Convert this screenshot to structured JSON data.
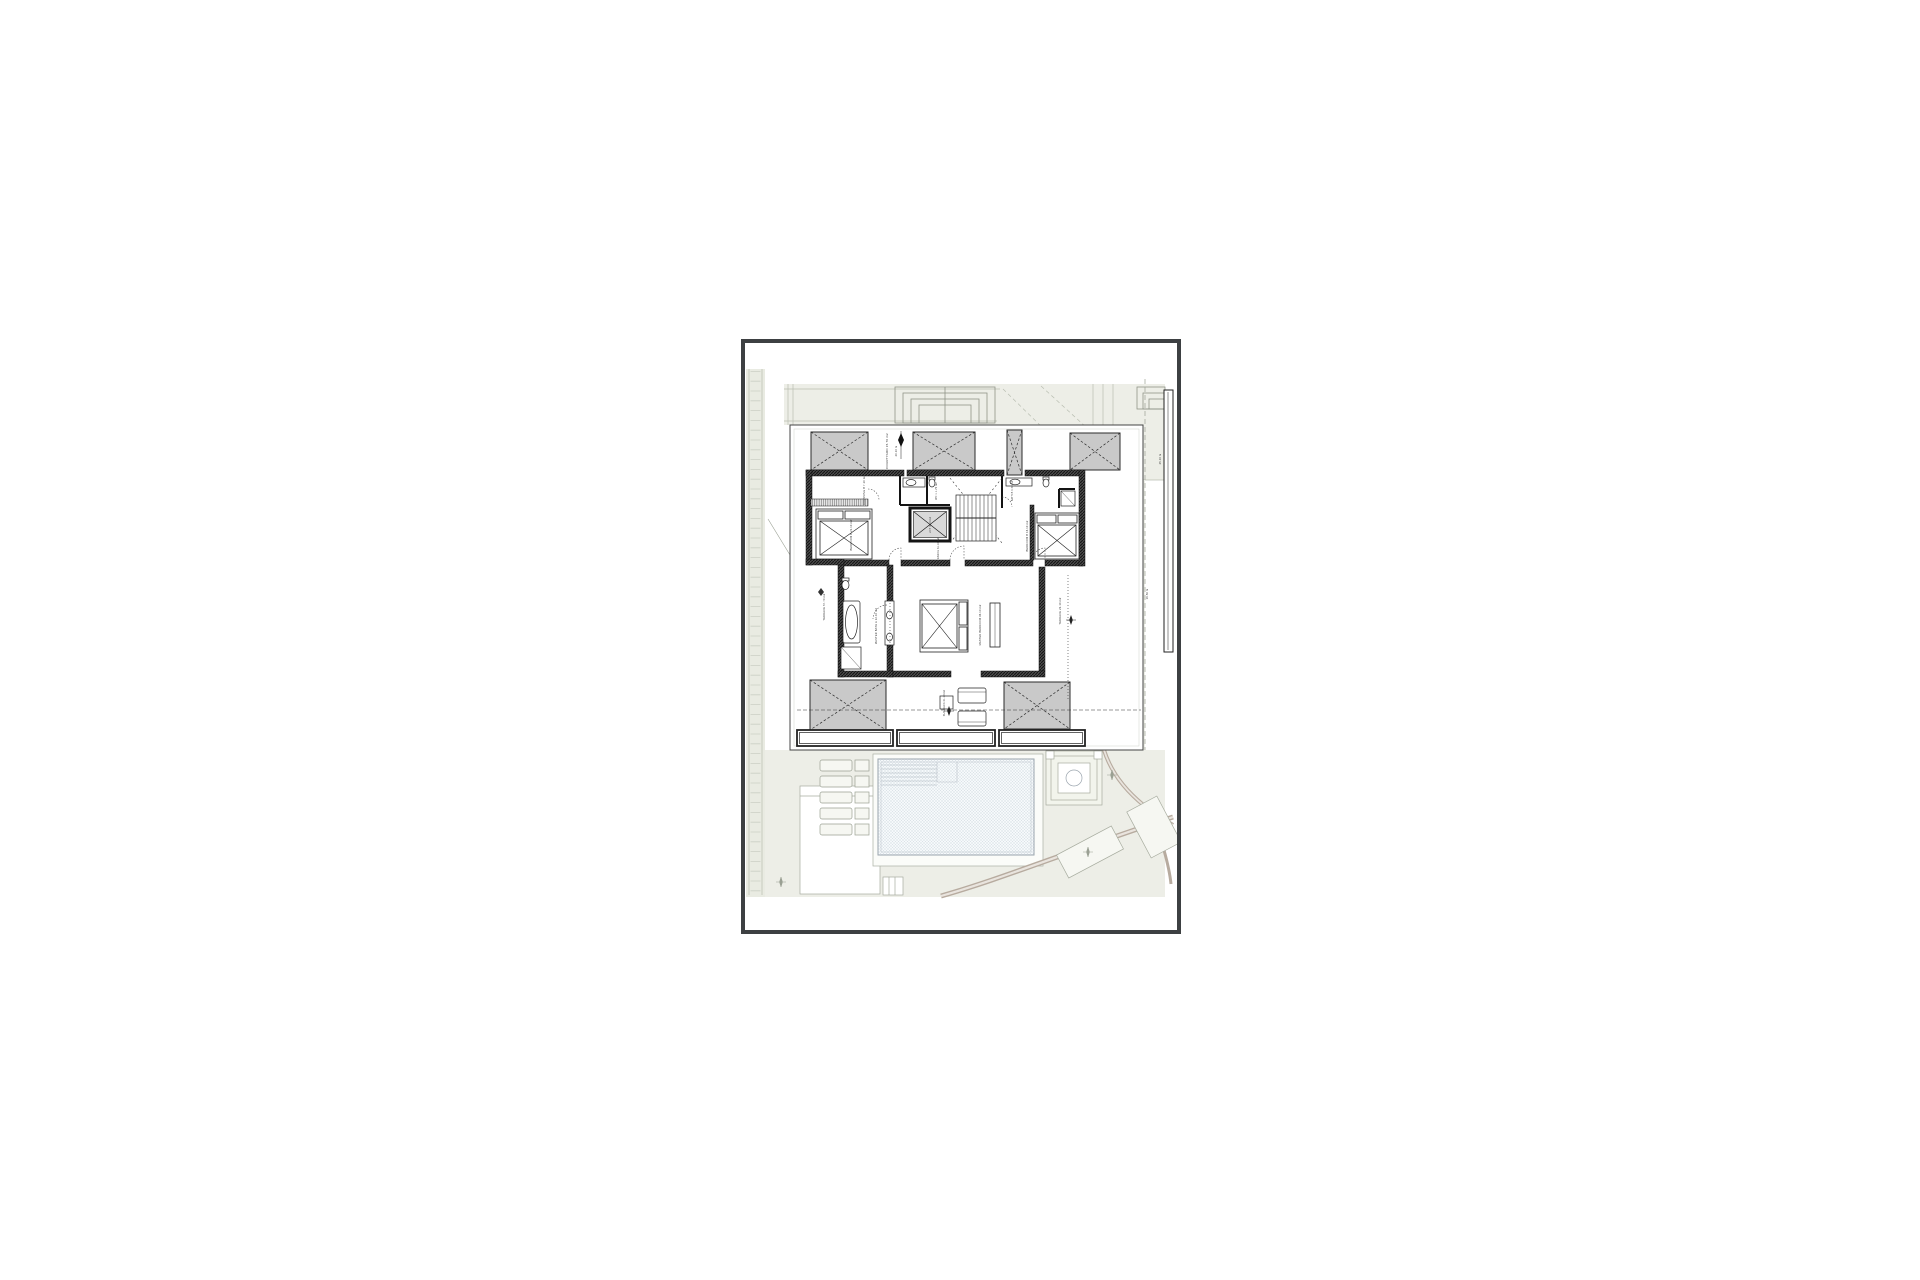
{
  "document": {
    "type": "architectural floor plan sheet",
    "background": "#ffffff",
    "sheet_border_color": "#3d4042",
    "site_tint_color": "#edeee7",
    "site_line_color": "#b9beb1",
    "road_color": "#b7ab9f",
    "wall_color": "#1a1a1a",
    "roof_hatch_fill": "#c9c9c9",
    "pool_line_color": "#9aa4ad"
  },
  "labels": [
    {
      "id": "courtyard",
      "text": "COURTYARD 15.70 m2"
    },
    {
      "id": "dim-top",
      "text": "20.10 m"
    },
    {
      "id": "dressing",
      "text": "DRESSING B 7.10 m2"
    },
    {
      "id": "bedroom-b",
      "text": "BEDROOM B 21.10 m2"
    },
    {
      "id": "wc-1",
      "text": "WC 1  1.70 m2"
    },
    {
      "id": "lift",
      "text": "LIFT 3.10 m2"
    },
    {
      "id": "bath-b",
      "text": "BATH B 4.70 m2"
    },
    {
      "id": "bedroom-c",
      "text": "BEDROOM B 16.10 m2"
    },
    {
      "id": "hall",
      "text": "ENTRANCE 31.10 m2"
    },
    {
      "id": "terrace-left",
      "text": "TERRACE 57.70 m2"
    },
    {
      "id": "master-bath",
      "text": "MASTER BATH A 12.10 m2"
    },
    {
      "id": "master-bedroom",
      "text": "MASTER BEDROOM 36.10 m2"
    },
    {
      "id": "terrace-right",
      "text": "TERRACE 23.10 m2"
    },
    {
      "id": "sun-deck",
      "text": "SUN DECK 21.10 m2"
    },
    {
      "id": "dim-right",
      "text": "19.50 m"
    },
    {
      "id": "dim-top-right",
      "text": "25.10 m"
    }
  ]
}
